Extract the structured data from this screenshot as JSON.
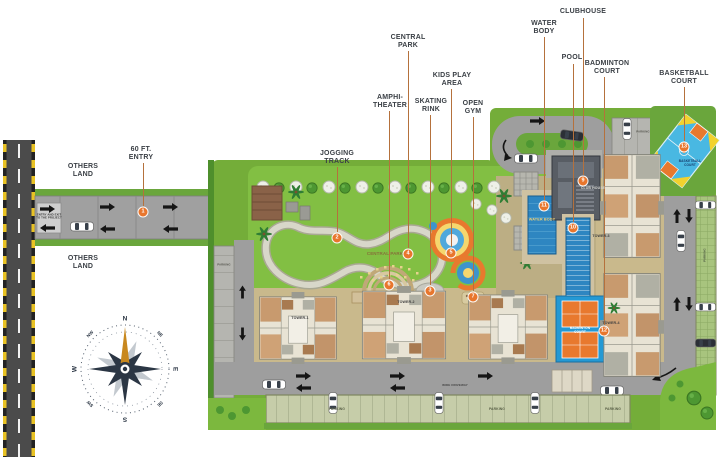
{
  "palette": {
    "label": "#3b4046",
    "leader": "#b5713c",
    "badge": "#e8762d",
    "compass": "#2b3644",
    "lawn": "#7cb83e",
    "road": "#9e9e9e",
    "asphalt": "#4b4b4b",
    "podium": "#c9b98c",
    "water": "#2e86c1",
    "court_blue": "#49b8e2",
    "court_orange": "#e8792e",
    "north_gold": "#c8881f"
  },
  "callouts": [
    {
      "id": "entry-60ft",
      "num": "1",
      "label": "60 FT.\nENTRY",
      "lx": 141,
      "ly": 146,
      "line": {
        "x": 143,
        "y1": 163,
        "y2": 206
      },
      "badge": {
        "x": 143,
        "y": 212
      }
    },
    {
      "id": "jogging-track",
      "num": "2",
      "label": "JOGGING\nTRACK",
      "lx": 337,
      "ly": 150,
      "line": {
        "x": 337,
        "y1": 167,
        "y2": 232
      },
      "badge": {
        "x": 337,
        "y": 238
      }
    },
    {
      "id": "central-park",
      "num": "4",
      "label": "CENTRAL\nPARK",
      "lx": 408,
      "ly": 34,
      "line": {
        "x": 408,
        "y1": 51,
        "y2": 248
      },
      "badge": {
        "x": 408,
        "y": 254
      }
    },
    {
      "id": "amphi-theater",
      "num": "6",
      "label": "AMPHI-\nTHEATER",
      "lx": 390,
      "ly": 94,
      "line": {
        "x": 389,
        "y1": 111,
        "y2": 279
      },
      "badge": {
        "x": 389,
        "y": 285
      }
    },
    {
      "id": "skating-rink",
      "num": "3",
      "label": "SKATING\nRINK",
      "lx": 431,
      "ly": 98,
      "line": {
        "x": 430,
        "y1": 115,
        "y2": 285
      },
      "badge": {
        "x": 430,
        "y": 291
      }
    },
    {
      "id": "kids-play-area",
      "num": "5",
      "label": "KIDS PLAY\nAREA",
      "lx": 452,
      "ly": 72,
      "line": {
        "x": 451,
        "y1": 89,
        "y2": 247
      },
      "badge": {
        "x": 451,
        "y": 253
      }
    },
    {
      "id": "open-gym",
      "num": "7",
      "label": "OPEN\nGYM",
      "lx": 473,
      "ly": 100,
      "line": {
        "x": 473,
        "y1": 117,
        "y2": 291
      },
      "badge": {
        "x": 473,
        "y": 297
      }
    },
    {
      "id": "water-body",
      "num": "11",
      "label": "WATER\nBODY",
      "lx": 544,
      "ly": 20,
      "line": {
        "x": 544,
        "y1": 37,
        "y2": 200
      },
      "badge": {
        "x": 544,
        "y": 206
      }
    },
    {
      "id": "clubhouse",
      "num": "9",
      "label": "CLUBHOUSE",
      "lx": 583,
      "ly": 8,
      "line": {
        "x": 583,
        "y1": 18,
        "y2": 175
      },
      "badge": {
        "x": 583,
        "y": 181
      }
    },
    {
      "id": "pool",
      "num": "10",
      "label": "POOL",
      "lx": 572,
      "ly": 54,
      "line": {
        "x": 573,
        "y1": 64,
        "y2": 222
      },
      "badge": {
        "x": 573,
        "y": 228
      }
    },
    {
      "id": "badminton-court",
      "num": "12",
      "label": "BADMINTON\nCOURT",
      "lx": 607,
      "ly": 60,
      "line": {
        "x": 604,
        "y1": 77,
        "y2": 325
      },
      "badge": {
        "x": 604,
        "y": 331
      }
    },
    {
      "id": "basketball-court",
      "num": "13",
      "label": "BASKETBALL\nCOURT",
      "lx": 684,
      "ly": 70,
      "line": {
        "x": 684,
        "y1": 87,
        "y2": 141
      },
      "badge": {
        "x": 684,
        "y": 147
      }
    },
    {
      "id": "others-land-1",
      "label": "OTHERS\nLAND",
      "lx": 83,
      "ly": 163
    },
    {
      "id": "others-land-2",
      "label": "OTHERS\nLAND",
      "lx": 83,
      "ly": 255
    }
  ],
  "map_texts": [
    {
      "id": "central-park-lawn",
      "text": "CENTRAL PARK",
      "x": 385,
      "y": 254,
      "s": 4.5,
      "c": "#86713a"
    },
    {
      "id": "water-body-pool",
      "text": "WATER BODY",
      "x": 542,
      "y": 220,
      "s": 3.8,
      "c": "#f2d277"
    },
    {
      "id": "club-house",
      "text": "CLUB HOUSE",
      "x": 593,
      "y": 188,
      "s": 3.5,
      "c": "#d8d8d4"
    },
    {
      "id": "badminton-label",
      "text": "BADMINTON\nCOURT",
      "x": 580,
      "y": 330,
      "s": 3.2,
      "c": "#ffffff"
    },
    {
      "id": "basketball-label",
      "text": "BASKETBALL\nCOURT",
      "x": 690,
      "y": 163,
      "s": 3.2,
      "c": "#163e6e"
    },
    {
      "id": "tower-1",
      "text": "TOWER-1",
      "x": 300,
      "y": 318,
      "s": 3.6,
      "c": "#3f3f3f"
    },
    {
      "id": "tower-2",
      "text": "TOWER-2",
      "x": 406,
      "y": 302,
      "s": 3.6,
      "c": "#3f3f3f"
    },
    {
      "id": "tower-3",
      "text": "TOWER-3",
      "x": 601,
      "y": 236,
      "s": 3.6,
      "c": "#3f3f3f"
    },
    {
      "id": "tower-4",
      "text": "TOWER-4",
      "x": 611,
      "y": 323,
      "s": 3.6,
      "c": "#3f3f3f"
    },
    {
      "id": "parking-bottom-1",
      "text": "PARKING",
      "x": 337,
      "y": 409,
      "s": 3.4,
      "c": "#5a6148"
    },
    {
      "id": "parking-bottom-2",
      "text": "PARKING",
      "x": 497,
      "y": 409,
      "s": 3.4,
      "c": "#5a6148"
    },
    {
      "id": "parking-bottom-3",
      "text": "PARKING",
      "x": 613,
      "y": 409,
      "s": 3.4,
      "c": "#5a6148"
    },
    {
      "id": "parking-left",
      "text": "PARKING",
      "x": 224,
      "y": 265,
      "s": 2.8,
      "c": "#55554e"
    },
    {
      "id": "parking-top",
      "text": "PARKING",
      "x": 643,
      "y": 132,
      "s": 2.8,
      "c": "#55554e"
    },
    {
      "id": "parking-right",
      "text": "PARKING",
      "x": 705,
      "y": 255,
      "s": 2.8,
      "c": "#4c5840",
      "rot": -90
    },
    {
      "id": "driveway",
      "text": "WIDE DRIVEWAY",
      "x": 455,
      "y": 386,
      "s": 3,
      "c": "#454545"
    },
    {
      "id": "entry-exit-sign",
      "text": "ENTRY AND EXIT\nTO THE PROJECT",
      "x": 49,
      "y": 217,
      "s": 2.8,
      "c": "#333333"
    }
  ],
  "compass": {
    "points": [
      "N",
      "NE",
      "E",
      "SE",
      "S",
      "SW",
      "W",
      "NW"
    ],
    "cx": 125,
    "cy": 369,
    "r": 50
  }
}
